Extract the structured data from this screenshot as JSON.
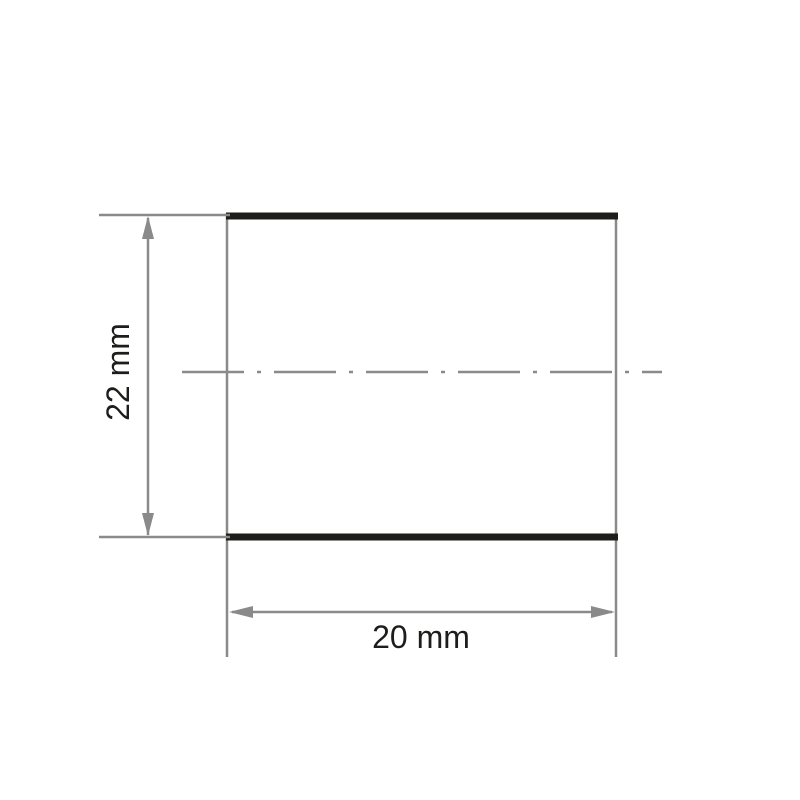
{
  "drawing": {
    "labels": {
      "height": "22 mm",
      "width": "20 mm"
    },
    "colors": {
      "outline": "#1d1d1b",
      "dimension_gray": "#8a8a8a",
      "background": "#ffffff"
    }
  }
}
